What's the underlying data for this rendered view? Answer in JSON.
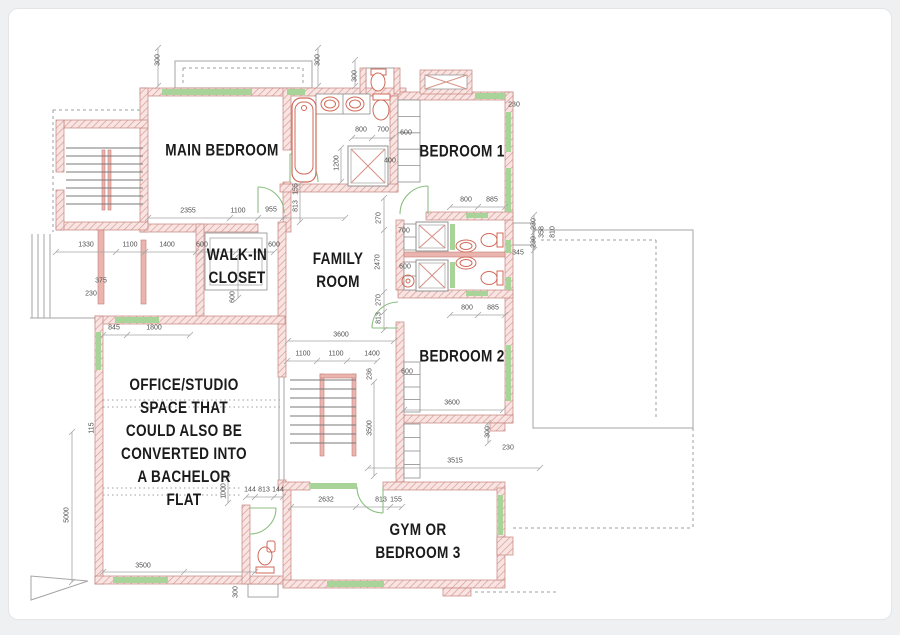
{
  "colors": {
    "bg": "#eef0f2",
    "card": "#ffffff",
    "card_border": "#e3e5e8",
    "wall_fill": "#f8e4e2",
    "wall_hatch": "#dc9b95",
    "wall_stroke": "#c4837d",
    "accent_wall": "#eab5ae",
    "accent_stroke": "#c57f78",
    "window": "#a8d49a",
    "door": "#8cbf80",
    "fixture": "#d06a58",
    "shower_x": "#d89388",
    "box_stroke": "#909090",
    "dim_text": "#4f4f4f",
    "line": "#a5a5a5",
    "dash": "#9aa0a6",
    "label": "#1b1b1b",
    "tread": "#787878",
    "shelf": "#8d8d8d"
  },
  "rooms": [
    {
      "id": "main-bedroom",
      "lines": [
        "MAIN BEDROOM"
      ],
      "x": 222,
      "y": 150
    },
    {
      "id": "bedroom-1",
      "lines": [
        "BEDROOM 1"
      ],
      "x": 462,
      "y": 151
    },
    {
      "id": "walk-in-closet",
      "lines": [
        "WALK-IN",
        "CLOSET"
      ],
      "x": 237,
      "y": 266
    },
    {
      "id": "family-room",
      "lines": [
        "FAMILY",
        "ROOM"
      ],
      "x": 338,
      "y": 270
    },
    {
      "id": "bedroom-2",
      "lines": [
        "BEDROOM 2"
      ],
      "x": 462,
      "y": 356
    },
    {
      "id": "office-studio",
      "lines": [
        "OFFICE/STUDIO",
        "SPACE THAT",
        "COULD ALSO BE",
        "CONVERTED INTO",
        "A BACHELOR",
        "FLAT"
      ],
      "x": 184,
      "y": 442
    },
    {
      "id": "gym-bedroom-3",
      "lines": [
        "GYM OR",
        "BEDROOM 3"
      ],
      "x": 418,
      "y": 541
    }
  ],
  "dimensions": [
    {
      "t": "300",
      "x": 158,
      "y": 60,
      "r": 1
    },
    {
      "t": "300",
      "x": 318,
      "y": 60,
      "r": 1
    },
    {
      "t": "300",
      "x": 355,
      "y": 76,
      "r": 1
    },
    {
      "t": "230",
      "x": 514,
      "y": 105,
      "r": 0
    },
    {
      "t": "2355",
      "x": 188,
      "y": 211,
      "r": 0
    },
    {
      "t": "1100",
      "x": 238,
      "y": 211,
      "r": 0
    },
    {
      "t": "955",
      "x": 271,
      "y": 210,
      "r": 0
    },
    {
      "t": "800",
      "x": 361,
      "y": 130,
      "r": 0
    },
    {
      "t": "700",
      "x": 383,
      "y": 130,
      "r": 0
    },
    {
      "t": "600",
      "x": 406,
      "y": 133,
      "r": 0
    },
    {
      "t": "400",
      "x": 390,
      "y": 161,
      "r": 0
    },
    {
      "t": "1200",
      "x": 337,
      "y": 163,
      "r": 1
    },
    {
      "t": "155",
      "x": 296,
      "y": 189,
      "r": 1
    },
    {
      "t": "813",
      "x": 296,
      "y": 206,
      "r": 1
    },
    {
      "t": "800",
      "x": 466,
      "y": 200,
      "r": 0
    },
    {
      "t": "885",
      "x": 492,
      "y": 200,
      "r": 0
    },
    {
      "t": "1330",
      "x": 86,
      "y": 245,
      "r": 0
    },
    {
      "t": "1100",
      "x": 130,
      "y": 245,
      "r": 0
    },
    {
      "t": "1400",
      "x": 167,
      "y": 245,
      "r": 0
    },
    {
      "t": "375",
      "x": 101,
      "y": 281,
      "r": 0
    },
    {
      "t": "230",
      "x": 91,
      "y": 294,
      "r": 0
    },
    {
      "t": "600",
      "x": 202,
      "y": 245,
      "r": 0
    },
    {
      "t": "600",
      "x": 274,
      "y": 245,
      "r": 0
    },
    {
      "t": "600",
      "x": 233,
      "y": 297,
      "r": 1
    },
    {
      "t": "270",
      "x": 379,
      "y": 218,
      "r": 1
    },
    {
      "t": "700",
      "x": 404,
      "y": 231,
      "r": 0
    },
    {
      "t": "2470",
      "x": 378,
      "y": 262,
      "r": 1
    },
    {
      "t": "600",
      "x": 405,
      "y": 267,
      "r": 0
    },
    {
      "t": "270",
      "x": 379,
      "y": 300,
      "r": 1
    },
    {
      "t": "813",
      "x": 379,
      "y": 318,
      "r": 1
    },
    {
      "t": "3600",
      "x": 341,
      "y": 335,
      "r": 0
    },
    {
      "t": "1100",
      "x": 303,
      "y": 354,
      "r": 0
    },
    {
      "t": "1100",
      "x": 336,
      "y": 354,
      "r": 0
    },
    {
      "t": "1400",
      "x": 372,
      "y": 354,
      "r": 0
    },
    {
      "t": "236",
      "x": 370,
      "y": 374,
      "r": 1
    },
    {
      "t": "600",
      "x": 407,
      "y": 372,
      "r": 0
    },
    {
      "t": "800",
      "x": 467,
      "y": 308,
      "r": 0
    },
    {
      "t": "885",
      "x": 493,
      "y": 308,
      "r": 0
    },
    {
      "t": "345",
      "x": 518,
      "y": 253,
      "r": 0
    },
    {
      "t": "230",
      "x": 534,
      "y": 224,
      "r": 1
    },
    {
      "t": "230",
      "x": 534,
      "y": 242,
      "r": 1
    },
    {
      "t": "358",
      "x": 542,
      "y": 232,
      "r": 1
    },
    {
      "t": "810",
      "x": 553,
      "y": 232,
      "r": 1
    },
    {
      "t": "3600",
      "x": 452,
      "y": 403,
      "r": 0
    },
    {
      "t": "300",
      "x": 488,
      "y": 432,
      "r": 1
    },
    {
      "t": "230",
      "x": 508,
      "y": 448,
      "r": 0
    },
    {
      "t": "3515",
      "x": 455,
      "y": 461,
      "r": 0
    },
    {
      "t": "3500",
      "x": 370,
      "y": 428,
      "r": 1
    },
    {
      "t": "2632",
      "x": 326,
      "y": 500,
      "r": 0
    },
    {
      "t": "813",
      "x": 381,
      "y": 500,
      "r": 0
    },
    {
      "t": "155",
      "x": 396,
      "y": 500,
      "r": 0
    },
    {
      "t": "845",
      "x": 114,
      "y": 328,
      "r": 0
    },
    {
      "t": "1800",
      "x": 154,
      "y": 328,
      "r": 0
    },
    {
      "t": "115",
      "x": 92,
      "y": 428,
      "r": 1
    },
    {
      "t": "5000",
      "x": 67,
      "y": 515,
      "r": 1
    },
    {
      "t": "1000",
      "x": 224,
      "y": 491,
      "r": 1
    },
    {
      "t": "144",
      "x": 250,
      "y": 490,
      "r": 0
    },
    {
      "t": "813",
      "x": 264,
      "y": 490,
      "r": 0
    },
    {
      "t": "144",
      "x": 278,
      "y": 490,
      "r": 0
    },
    {
      "t": "3500",
      "x": 143,
      "y": 566,
      "r": 0
    },
    {
      "t": "300",
      "x": 236,
      "y": 592,
      "r": 1
    }
  ]
}
